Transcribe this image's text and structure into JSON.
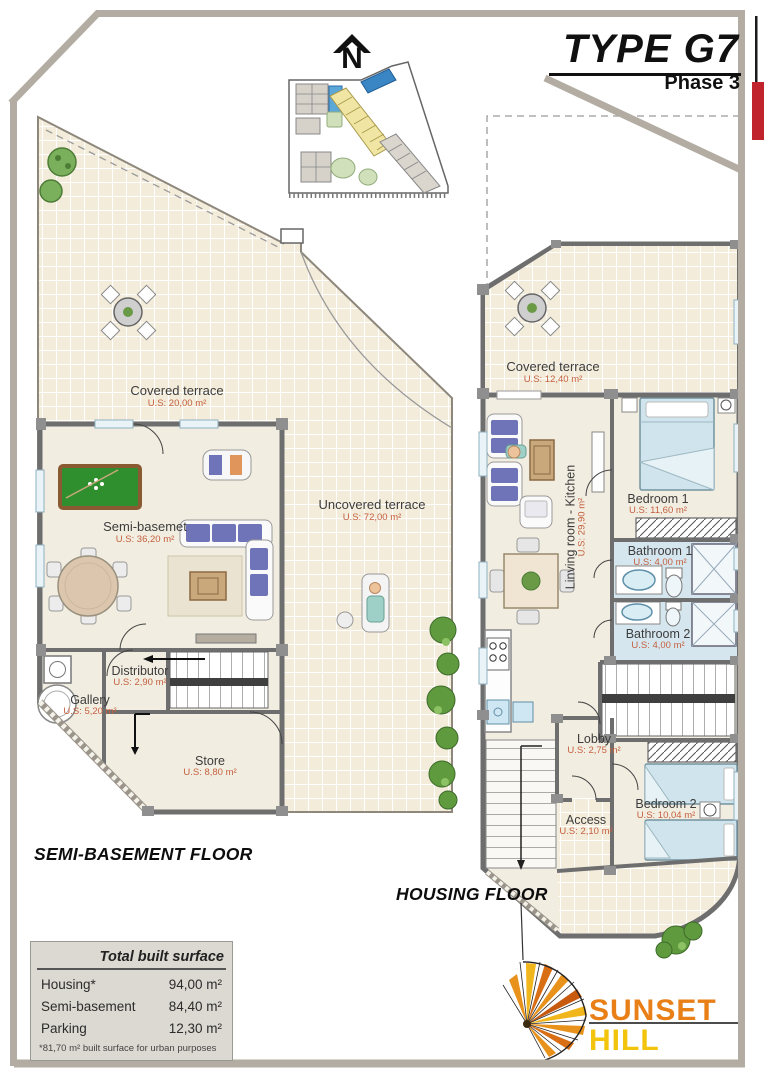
{
  "header": {
    "type_title": "TYPE G7",
    "phase": "Phase 3",
    "north_label": "N"
  },
  "semi_basement_plan": {
    "floor_label": "SEMI-BASEMENT FLOOR",
    "rooms": [
      {
        "name": "Covered terrace",
        "area": "U.S: 20,00 m²"
      },
      {
        "name": "Semi-basemet",
        "area": "U.S: 36,20 m²"
      },
      {
        "name": "Uncovered terrace",
        "area": "U.S: 72,00 m²"
      },
      {
        "name": "Distributor",
        "area": "U.S: 2,90 m²"
      },
      {
        "name": "Gallery",
        "area": "U.S: 5,20 m²"
      },
      {
        "name": "Store",
        "area": "U.S: 8,80 m²"
      }
    ]
  },
  "housing_plan": {
    "floor_label": "HOUSING FLOOR",
    "rooms": [
      {
        "name": "Covered terrace",
        "area": "U.S: 12,40 m²"
      },
      {
        "name": "Bedroom 1",
        "area": "U.S: 11,60 m²"
      },
      {
        "name": "Bathroom 1",
        "area": "U.S: 4,00 m²"
      },
      {
        "name": "Bathroom 2",
        "area": "U.S: 4,00 m²"
      },
      {
        "name": "Linving room - Kitchen",
        "area": "U.S: 29,90 m²"
      },
      {
        "name": "Lobby",
        "area": "U.S: 2,75 m²"
      },
      {
        "name": "Access",
        "area": "U.S: 2,10 m²"
      },
      {
        "name": "Bedroom 2",
        "area": "U.S: 10,04 m²"
      }
    ]
  },
  "surface_table": {
    "title": "Total built surface",
    "rows": [
      {
        "label": "Housing*",
        "value": "94,00 m²"
      },
      {
        "label": "Semi-basement",
        "value": "84,40 m²"
      },
      {
        "label": "Parking",
        "value": "12,30 m²"
      }
    ],
    "footnote": "*81,70 m² built surface for urban purposes"
  },
  "logo": {
    "line1": "SUNSET",
    "line2": "HILL"
  },
  "colors": {
    "frame": "#b3aca2",
    "accent_red": "#c0232b",
    "area_label": "#c4603f",
    "logo_orange": "#e87f17",
    "logo_yellow": "#f2c50c",
    "tile_cream": "#f3ecda",
    "bathroom_blue": "#d6e6ee",
    "plant_green": "#5f9a3e",
    "pool_table_green": "#2f8f2f"
  }
}
